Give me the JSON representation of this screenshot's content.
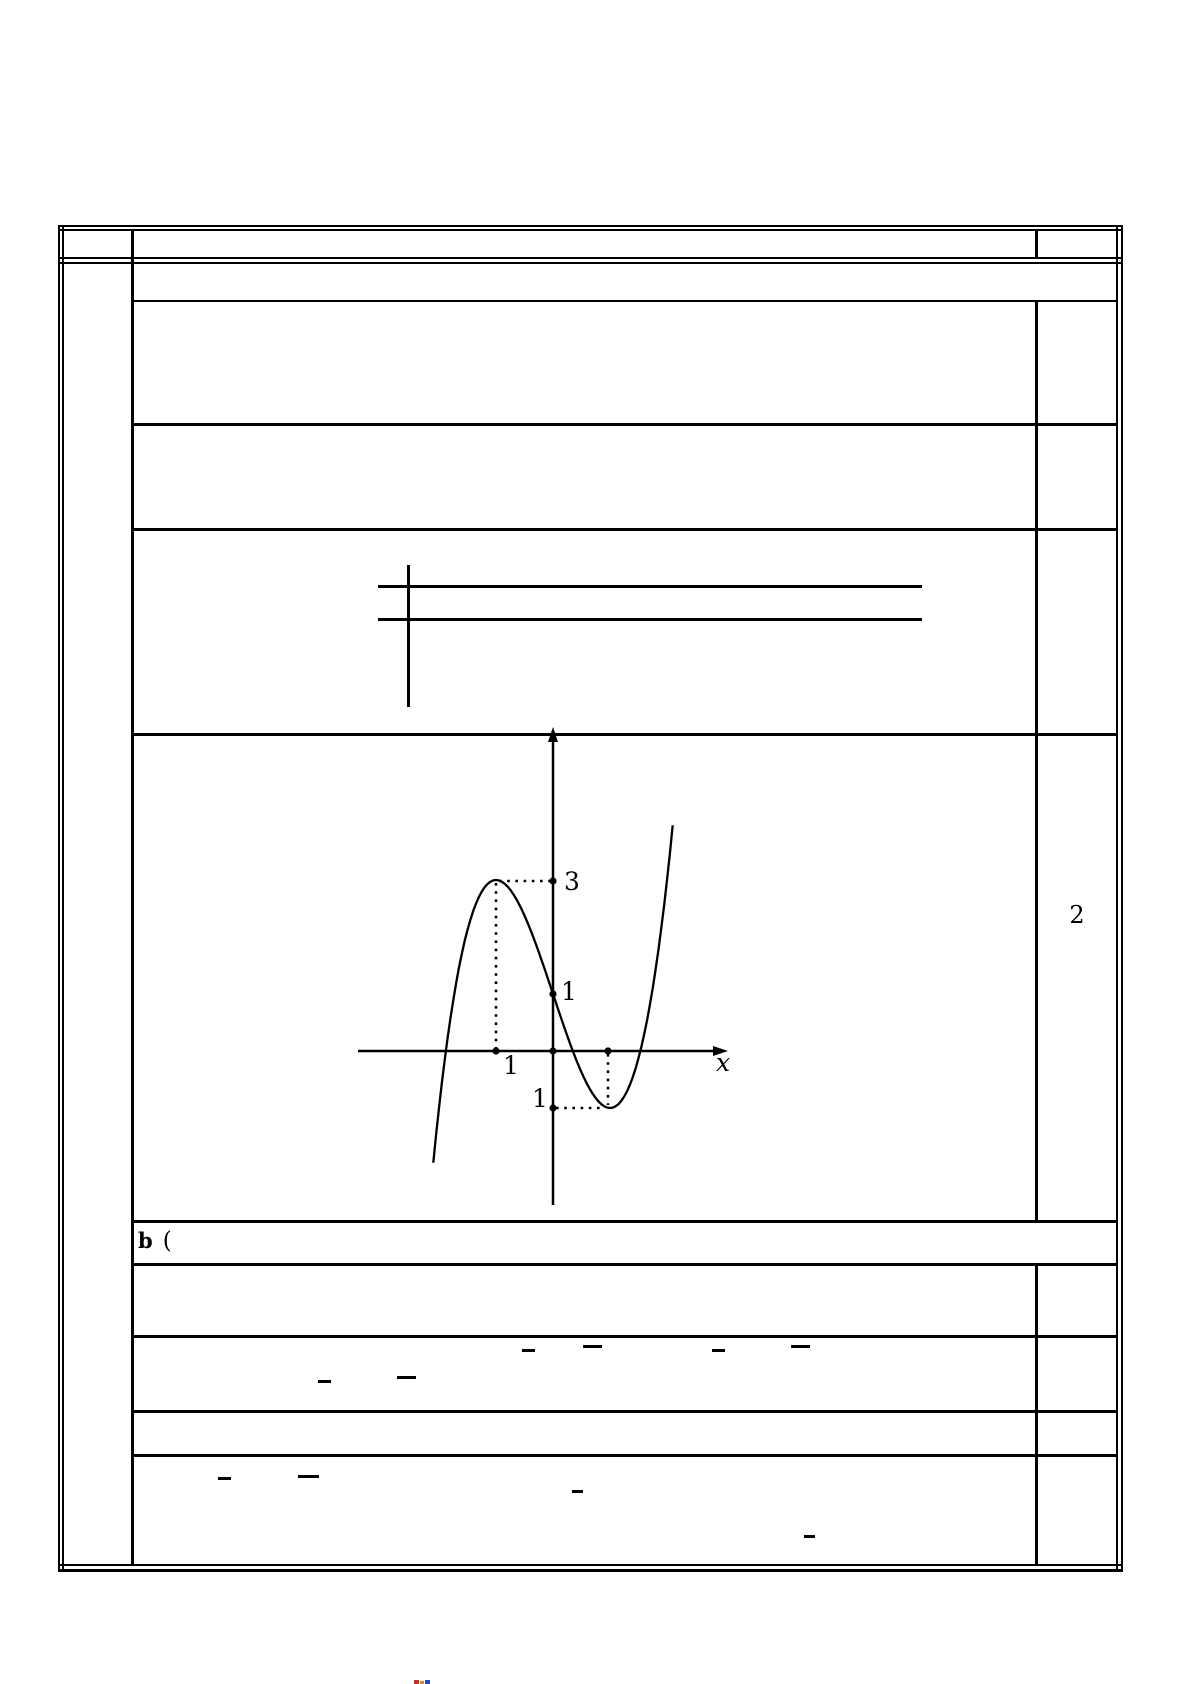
{
  "document": {
    "kind": "math exam solution table",
    "score_cell_value": "2",
    "part_b_label": "b",
    "part_b_paren": "(",
    "ink_color": "#000000",
    "paper_color": "#ffffff"
  },
  "chart_data": {
    "type": "line",
    "title": "",
    "function": "f(x) = x^3 - 3x + 1",
    "poly_coefficients": [
      1,
      0,
      -3,
      1
    ],
    "x_domain": [
      -2.1,
      2.1
    ],
    "key_points": {
      "local_max": [
        -1,
        3
      ],
      "y_intercept": [
        0,
        1
      ],
      "local_min": [
        1,
        -1
      ]
    },
    "axis_labels": {
      "x": "x"
    },
    "tick_labels": {
      "y_max": "3",
      "y_intercept": "1",
      "x_minus_one_as_rendered": "1",
      "y_minus_one_as_rendered": "1"
    },
    "legend": "none",
    "grid": "off",
    "pixel_map": {
      "origin_x": 553,
      "origin_y": 1051,
      "units_per_px": 57
    },
    "samples_step": 0.05
  }
}
